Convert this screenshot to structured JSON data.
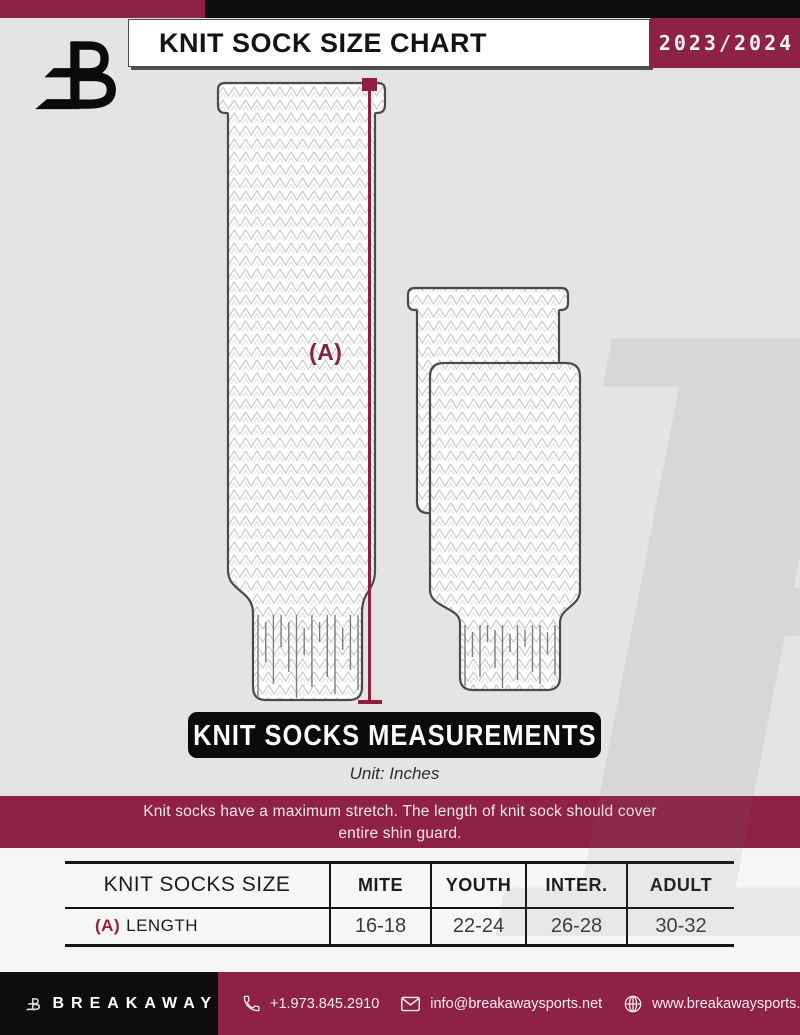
{
  "header": {
    "title": "KNIT SOCK SIZE CHART",
    "season": "2023/2024",
    "logo_icon": "breakaway-b-logo"
  },
  "diagram": {
    "measure_label": "(A)",
    "banner_title": "KNIT SOCKS MEASUREMENTS",
    "unit_label": "Unit: Inches",
    "note_line1": "Knit socks have a maximum stretch. The length of knit sock should cover",
    "note_line2": "entire shin guard."
  },
  "table": {
    "col_headers": [
      "KNIT SOCKS SIZE",
      "MITE",
      "YOUTH",
      "INTER.",
      "ADULT"
    ],
    "rows": [
      {
        "prefix": "(A)",
        "label": "LENGTH",
        "values": [
          "16-18",
          "22-24",
          "26-28",
          "30-32"
        ]
      }
    ]
  },
  "footer": {
    "brand": "BREAKAWAY",
    "phone": "+1.973.845.2910",
    "email": "info@breakawaysports.net",
    "website": "www.breakawaysports.net",
    "icons": [
      "phone-icon",
      "envelope-icon",
      "globe-icon"
    ]
  },
  "watermark": {
    "letter": "B"
  },
  "colors": {
    "maroon": "#8e2244",
    "black": "#0d0d0d",
    "measure_line": "#8e1f40",
    "sock_outline": "#4a4a4c",
    "knit_stitch": "#c6c6c8",
    "bg_top": "#e4e4e3",
    "bg_bottom": "#f6f6f5"
  }
}
